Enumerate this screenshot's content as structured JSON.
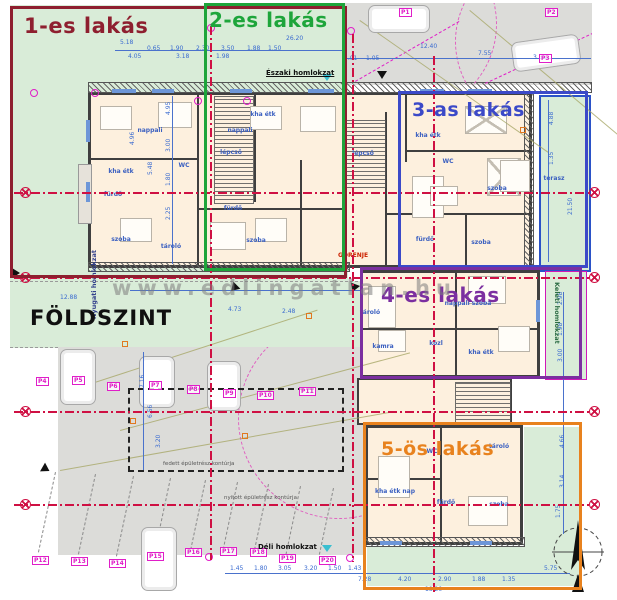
{
  "plan": {
    "floor_label": "FÖLDSZINT",
    "watermark": "www.edlingatlan.hu",
    "facades": {
      "north": "Északi homlokzat",
      "south": "Déli homlokzat",
      "west": "Nyugati homlokzat",
      "east": "Keleti homlokzat"
    },
    "note_red": "GORENJE",
    "contour_notes": [
      {
        "t": "fedett épületrész kontúrja",
        "x": 163,
        "y": 461
      },
      {
        "t": "nyitott épületrész kontúrja",
        "x": 224,
        "y": 495
      }
    ]
  },
  "colors": {
    "apartment1": "#8e1f2f",
    "apartment2": "#1ea53b",
    "apartment3": "#3b49c8",
    "apartment4": "#7b2fa0",
    "apartment5": "#e8821e",
    "garden_green": "#d9ecd8",
    "parking_gray": "#dcdcd9",
    "building_fill": "#fdf0de",
    "dimension_blue": "#3a6bd0",
    "parking_magenta": "#e01ec8",
    "axis_red": "#cf1043"
  },
  "apartments": [
    {
      "id": "1",
      "label": "1-es lakás",
      "color": "#8e1f2f",
      "box": [
        10,
        6,
        337,
        272
      ],
      "label_pos": [
        24,
        14
      ],
      "font": 21
    },
    {
      "id": "2",
      "label": "2-es lakás",
      "color": "#1ea53b",
      "box": [
        204,
        3,
        141,
        268
      ],
      "label_pos": [
        209,
        8
      ],
      "font": 20
    },
    {
      "id": "3",
      "label": "3-as lakás",
      "color": "#3b49c8",
      "box": [
        398,
        91,
        190,
        177
      ],
      "label_pos": [
        412,
        99
      ],
      "font": 19
    },
    {
      "id": "4",
      "label": "4-es lakás",
      "color": "#7b2fa0",
      "box": [
        360,
        267,
        222,
        112
      ],
      "label_pos": [
        381,
        283
      ],
      "font": 20
    },
    {
      "id": "5",
      "label": "5-ös lakás",
      "color": "#e8821e",
      "box": [
        363,
        422,
        219,
        168
      ],
      "label_pos": [
        381,
        438
      ],
      "font": 19
    }
  ],
  "parking": {
    "spots": [
      {
        "label": "P1",
        "x": 399,
        "y": 8
      },
      {
        "label": "P2",
        "x": 545,
        "y": 8
      },
      {
        "label": "P3",
        "x": 539,
        "y": 54
      },
      {
        "label": "P4",
        "x": 36,
        "y": 377
      },
      {
        "label": "P5",
        "x": 72,
        "y": 376
      },
      {
        "label": "P6",
        "x": 107,
        "y": 382
      },
      {
        "label": "P7",
        "x": 149,
        "y": 381
      },
      {
        "label": "P8",
        "x": 187,
        "y": 385
      },
      {
        "label": "P9",
        "x": 223,
        "y": 389
      },
      {
        "label": "P10",
        "x": 257,
        "y": 391
      },
      {
        "label": "P11",
        "x": 299,
        "y": 387
      },
      {
        "label": "P12",
        "x": 32,
        "y": 556
      },
      {
        "label": "P13",
        "x": 71,
        "y": 557
      },
      {
        "label": "P14",
        "x": 109,
        "y": 559
      },
      {
        "label": "P15",
        "x": 147,
        "y": 552
      },
      {
        "label": "P16",
        "x": 185,
        "y": 548
      },
      {
        "label": "P17",
        "x": 220,
        "y": 547
      },
      {
        "label": "P18",
        "x": 250,
        "y": 548
      },
      {
        "label": "P19",
        "x": 279,
        "y": 554
      },
      {
        "label": "P20",
        "x": 319,
        "y": 556
      }
    ]
  },
  "rooms": [
    {
      "label": "nappali",
      "x": 150,
      "y": 127
    },
    {
      "label": "kha étk",
      "x": 121,
      "y": 168
    },
    {
      "label": "fürdő",
      "x": 113,
      "y": 191
    },
    {
      "label": "szoba",
      "x": 121,
      "y": 236
    },
    {
      "label": "tároló",
      "x": 171,
      "y": 243
    },
    {
      "label": "WC",
      "x": 184,
      "y": 162
    },
    {
      "label": "lépcső",
      "x": 231,
      "y": 149
    },
    {
      "label": "nappali",
      "x": 240,
      "y": 127
    },
    {
      "label": "kha étk",
      "x": 263,
      "y": 111
    },
    {
      "label": "szoba",
      "x": 256,
      "y": 237
    },
    {
      "label": "fürdő",
      "x": 233,
      "y": 205
    },
    {
      "label": "lépcső",
      "x": 363,
      "y": 150
    },
    {
      "label": "kha étk",
      "x": 428,
      "y": 132
    },
    {
      "label": "WC",
      "x": 448,
      "y": 158
    },
    {
      "label": "szoba",
      "x": 497,
      "y": 185
    },
    {
      "label": "fürdő",
      "x": 425,
      "y": 236
    },
    {
      "label": "szoba",
      "x": 481,
      "y": 239
    },
    {
      "label": "tároló",
      "x": 370,
      "y": 309
    },
    {
      "label": "kamra",
      "x": 383,
      "y": 343
    },
    {
      "label": "közl",
      "x": 436,
      "y": 340
    },
    {
      "label": "kha étk",
      "x": 481,
      "y": 349
    },
    {
      "label": "nappali szoba",
      "x": 468,
      "y": 300
    },
    {
      "label": "tároló",
      "x": 499,
      "y": 443
    },
    {
      "label": "WC",
      "x": 432,
      "y": 448
    },
    {
      "label": "kha étk nap",
      "x": 395,
      "y": 488
    },
    {
      "label": "fürdő",
      "x": 446,
      "y": 499
    },
    {
      "label": "szoba",
      "x": 499,
      "y": 501
    },
    {
      "label": "terasz",
      "x": 554,
      "y": 175
    }
  ],
  "dim_labels": [
    {
      "t": "5.18",
      "x": 120,
      "y": 40
    },
    {
      "t": "0.65",
      "x": 147,
      "y": 46
    },
    {
      "t": "1.90",
      "x": 170,
      "y": 46
    },
    {
      "t": "2.30",
      "x": 196,
      "y": 46
    },
    {
      "t": "3.50",
      "x": 221,
      "y": 46
    },
    {
      "t": "1.88",
      "x": 247,
      "y": 46
    },
    {
      "t": "1.50",
      "x": 268,
      "y": 46
    },
    {
      "t": "26.20",
      "x": 286,
      "y": 36
    },
    {
      "t": "4.05",
      "x": 128,
      "y": 54
    },
    {
      "t": "3.18",
      "x": 176,
      "y": 54
    },
    {
      "t": "1.98",
      "x": 216,
      "y": 54
    },
    {
      "t": "4.01",
      "x": 344,
      "y": 56
    },
    {
      "t": "1.05",
      "x": 366,
      "y": 56
    },
    {
      "t": "12.40",
      "x": 420,
      "y": 44
    },
    {
      "t": "7.55",
      "x": 478,
      "y": 51
    },
    {
      "t": "3.60",
      "x": 533,
      "y": 55
    },
    {
      "t": "4.95",
      "x": 166,
      "y": 115,
      "v": 1
    },
    {
      "t": "3.00",
      "x": 166,
      "y": 152,
      "v": 1
    },
    {
      "t": "1.80",
      "x": 166,
      "y": 186,
      "v": 1
    },
    {
      "t": "2.25",
      "x": 166,
      "y": 220,
      "v": 1
    },
    {
      "t": "4.96",
      "x": 130,
      "y": 145,
      "v": 1
    },
    {
      "t": "5.48",
      "x": 148,
      "y": 175,
      "v": 1
    },
    {
      "t": "7.16",
      "x": 140,
      "y": 388,
      "v": 1
    },
    {
      "t": "6.56",
      "x": 148,
      "y": 418,
      "v": 1
    },
    {
      "t": "3.20",
      "x": 156,
      "y": 448,
      "v": 1
    },
    {
      "t": "21.50",
      "x": 568,
      "y": 215,
      "v": 1
    },
    {
      "t": "4.88",
      "x": 549,
      "y": 125,
      "v": 1
    },
    {
      "t": "1.35",
      "x": 549,
      "y": 165,
      "v": 1
    },
    {
      "t": "2.98",
      "x": 558,
      "y": 305,
      "v": 1
    },
    {
      "t": "1.98",
      "x": 558,
      "y": 336,
      "v": 1
    },
    {
      "t": "3.00",
      "x": 558,
      "y": 362,
      "v": 1
    },
    {
      "t": "4.66",
      "x": 560,
      "y": 448,
      "v": 1
    },
    {
      "t": "3.14",
      "x": 560,
      "y": 488,
      "v": 1
    },
    {
      "t": "1.75",
      "x": 556,
      "y": 518,
      "v": 1
    },
    {
      "t": "1.45",
      "x": 230,
      "y": 566
    },
    {
      "t": "1.80",
      "x": 254,
      "y": 566
    },
    {
      "t": "3.05",
      "x": 278,
      "y": 566
    },
    {
      "t": "3.20",
      "x": 304,
      "y": 566
    },
    {
      "t": "1.50",
      "x": 328,
      "y": 566
    },
    {
      "t": "1.43",
      "x": 348,
      "y": 566
    },
    {
      "t": "7.28",
      "x": 358,
      "y": 577
    },
    {
      "t": "4.20",
      "x": 398,
      "y": 577
    },
    {
      "t": "2.90",
      "x": 438,
      "y": 577
    },
    {
      "t": "1.88",
      "x": 472,
      "y": 577
    },
    {
      "t": "1.35",
      "x": 502,
      "y": 577
    },
    {
      "t": "18.20",
      "x": 425,
      "y": 587
    },
    {
      "t": "5.75",
      "x": 544,
      "y": 566
    },
    {
      "t": "12.88",
      "x": 60,
      "y": 295
    },
    {
      "t": "4.73",
      "x": 228,
      "y": 307
    },
    {
      "t": "2.48",
      "x": 282,
      "y": 309
    }
  ],
  "deco": {
    "walls": [
      [
        197,
        92,
        2,
        176
      ],
      [
        254,
        92,
        2,
        110
      ],
      [
        385,
        112,
        2,
        156
      ],
      [
        405,
        92,
        2,
        70
      ],
      [
        88,
        158,
        110,
        2
      ],
      [
        197,
        208,
        150,
        2
      ],
      [
        405,
        150,
        127,
        2
      ],
      [
        385,
        213,
        147,
        2
      ],
      [
        465,
        215,
        2,
        53
      ],
      [
        300,
        160,
        2,
        108
      ],
      [
        455,
        270,
        2,
        108
      ],
      [
        360,
        328,
        180,
        2
      ],
      [
        440,
        425,
        2,
        120
      ],
      [
        365,
        478,
        75,
        2
      ]
    ],
    "stairs": [
      [
        214,
        96,
        38,
        106
      ],
      [
        344,
        120,
        40,
        66
      ],
      [
        455,
        382,
        54,
        40
      ]
    ],
    "hstrips": [
      [
        88,
        82,
        502,
        9
      ],
      [
        88,
        262,
        260,
        8
      ],
      [
        365,
        537,
        158,
        8
      ],
      [
        524,
        92,
        8,
        176
      ]
    ],
    "windows": [
      [
        112,
        89,
        24,
        4
      ],
      [
        152,
        89,
        22,
        4
      ],
      [
        230,
        89,
        22,
        4
      ],
      [
        308,
        89,
        26,
        4
      ],
      [
        420,
        89,
        24,
        4
      ],
      [
        468,
        89,
        24,
        4
      ],
      [
        86,
        120,
        4,
        22
      ],
      [
        86,
        182,
        4,
        20
      ],
      [
        380,
        541,
        22,
        4
      ],
      [
        470,
        541,
        22,
        4
      ],
      [
        536,
        300,
        4,
        22
      ]
    ],
    "blue_lines": [
      [
        115,
        50,
        228,
        1
      ],
      [
        343,
        58,
        248,
        1
      ],
      [
        225,
        573,
        345,
        1
      ],
      [
        172,
        96,
        1,
        168
      ],
      [
        563,
        292,
        1,
        242
      ],
      [
        143,
        352,
        1,
        118
      ],
      [
        548,
        100,
        1,
        162
      ],
      [
        130,
        290,
        230,
        1
      ]
    ],
    "crimson_h": [
      [
        14,
        192,
        578
      ],
      [
        14,
        277,
        578
      ],
      [
        14,
        411,
        578
      ],
      [
        14,
        504,
        578
      ]
    ],
    "crimson_v": [
      [
        210,
        26,
        534
      ],
      [
        352,
        34,
        528
      ],
      [
        433,
        56,
        536
      ]
    ],
    "axis_markers": [
      [
        20,
        187
      ],
      [
        20,
        272
      ],
      [
        20,
        406
      ],
      [
        20,
        499
      ],
      [
        589,
        187
      ],
      [
        589,
        272
      ],
      [
        589,
        406
      ],
      [
        589,
        499
      ]
    ],
    "magenta_circles": [
      [
        30,
        89
      ],
      [
        194,
        97
      ],
      [
        243,
        97
      ],
      [
        207,
        24
      ],
      [
        347,
        27
      ],
      [
        205,
        553
      ],
      [
        346,
        554
      ],
      [
        91,
        89
      ]
    ],
    "orange_squares": [
      [
        122,
        341
      ],
      [
        130,
        418
      ],
      [
        242,
        433
      ],
      [
        306,
        313
      ],
      [
        520,
        127
      ]
    ],
    "triangles": [
      [
        378,
        70,
        90
      ],
      [
        230,
        283,
        135
      ],
      [
        350,
        283,
        110
      ],
      [
        12,
        268,
        0
      ],
      [
        42,
        464,
        30
      ]
    ],
    "cyan_triangles": [
      [
        322,
        74
      ],
      [
        322,
        545
      ]
    ],
    "cars": [
      {
        "x": 368,
        "y": 5,
        "w": 60,
        "h": 26,
        "r": 0
      },
      {
        "x": 512,
        "y": 38,
        "w": 66,
        "h": 28,
        "r": -8
      },
      {
        "x": 60,
        "y": 349,
        "w": 34,
        "h": 54,
        "r": 0
      },
      {
        "x": 139,
        "y": 356,
        "w": 34,
        "h": 50,
        "r": 0
      },
      {
        "x": 207,
        "y": 361,
        "w": 32,
        "h": 48,
        "r": 0
      },
      {
        "x": 141,
        "y": 527,
        "w": 34,
        "h": 62,
        "r": 0
      }
    ],
    "furniture": [
      {
        "x": 100,
        "y": 106,
        "w": 30,
        "h": 22
      },
      {
        "x": 158,
        "y": 102,
        "w": 32,
        "h": 24
      },
      {
        "x": 250,
        "y": 106,
        "w": 30,
        "h": 22
      },
      {
        "x": 300,
        "y": 106,
        "w": 34,
        "h": 24
      },
      {
        "x": 120,
        "y": 218,
        "w": 30,
        "h": 22
      },
      {
        "x": 210,
        "y": 222,
        "w": 34,
        "h": 26
      },
      {
        "x": 255,
        "y": 218,
        "w": 30,
        "h": 22
      },
      {
        "x": 465,
        "y": 106,
        "w": 40,
        "h": 26,
        "c": 1
      },
      {
        "x": 487,
        "y": 158,
        "w": 32,
        "h": 36,
        "c": 1
      },
      {
        "x": 468,
        "y": 276,
        "w": 36,
        "h": 26
      },
      {
        "x": 368,
        "y": 286,
        "w": 26,
        "h": 40
      },
      {
        "x": 500,
        "y": 160,
        "w": 28,
        "h": 30
      },
      {
        "x": 412,
        "y": 176,
        "w": 30,
        "h": 40
      },
      {
        "x": 378,
        "y": 456,
        "w": 30,
        "h": 40
      },
      {
        "x": 468,
        "y": 496,
        "w": 38,
        "h": 28
      },
      {
        "x": 378,
        "y": 330,
        "w": 26,
        "h": 20
      },
      {
        "x": 498,
        "y": 326,
        "w": 30,
        "h": 24
      },
      {
        "x": 430,
        "y": 186,
        "w": 26,
        "h": 18
      }
    ],
    "spot_dividers": [
      [
        55,
        472,
        82,
        12
      ],
      [
        95,
        474,
        82,
        12
      ],
      [
        133,
        476,
        82,
        12
      ],
      [
        170,
        478,
        80,
        12
      ],
      [
        205,
        480,
        76,
        12
      ],
      [
        237,
        482,
        74,
        12
      ],
      [
        268,
        484,
        72,
        12
      ],
      [
        300,
        486,
        70,
        12
      ],
      [
        333,
        488,
        68,
        12
      ]
    ],
    "olive_lines": [
      [
        70,
        390,
        260,
        -18
      ],
      [
        120,
        430,
        300,
        -15
      ],
      [
        60,
        470,
        340,
        -10
      ],
      [
        360,
        20,
        230,
        35
      ],
      [
        470,
        10,
        220,
        40
      ]
    ]
  }
}
